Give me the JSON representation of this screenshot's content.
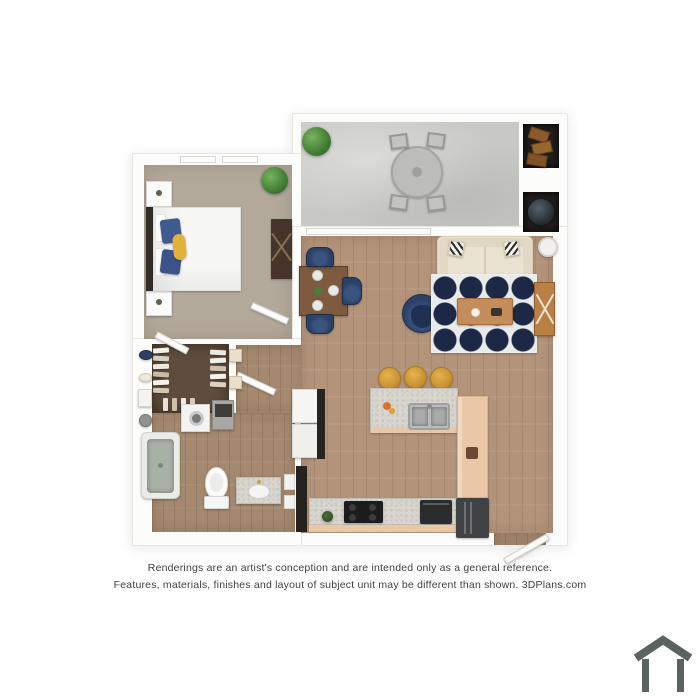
{
  "image": {
    "type": "3d-floor-plan-rendering",
    "width": 700,
    "height": 700
  },
  "disclaimer": {
    "line1": "Renderings are an artist's conception and are intended only as a general reference.",
    "line2": "Features, materials, finishes and layout of subject unit may be different than shown. 3DPlans.com"
  },
  "branding": {
    "site": "3DPlans.com",
    "logo": "house-outline-icon",
    "logo_color": "#5b6361"
  },
  "rooms": [
    "patio",
    "bedroom",
    "living-room",
    "dining-area",
    "kitchen",
    "hallway",
    "walk-in-closet",
    "bathroom",
    "storage-closet",
    "water-heater-closet"
  ],
  "furniture": [
    "patio-round-table",
    "patio-chairs",
    "potted-plants",
    "storage-boxes",
    "water-heater",
    "bed",
    "nightstands",
    "dresser",
    "dining-table",
    "navy-dining-chairs",
    "navy-armchair",
    "cream-sofa",
    "patterned-area-rug",
    "coffee-table",
    "x-side-table",
    "round-side-table",
    "kitchen-island",
    "double-sink",
    "yellow-bar-stools",
    "cooktop",
    "oven",
    "refrigerator",
    "stacked-washer-dryer",
    "pantry-shelves",
    "hanging-clothes",
    "bathtub",
    "toilet",
    "vanity-sink"
  ],
  "palette": {
    "wood_floor": "#b3947b",
    "bath_wood": "#a4886f",
    "carpet": "#b3a99b",
    "concrete": "#c8c9c5",
    "closet_floor": "#5e4c3c",
    "wall": "#fcfcfb",
    "rug_navy": "#1c2845",
    "sofa_cream": "#ebe3d1",
    "chair_navy": "#2c4166",
    "stool_yellow": "#d9a63d",
    "counter_salmon": "#eac7a7",
    "granite": "#d9d6d0",
    "tub_sage": "#a9b1a7",
    "logo_gray": "#5b6361",
    "text_gray": "#414141"
  }
}
